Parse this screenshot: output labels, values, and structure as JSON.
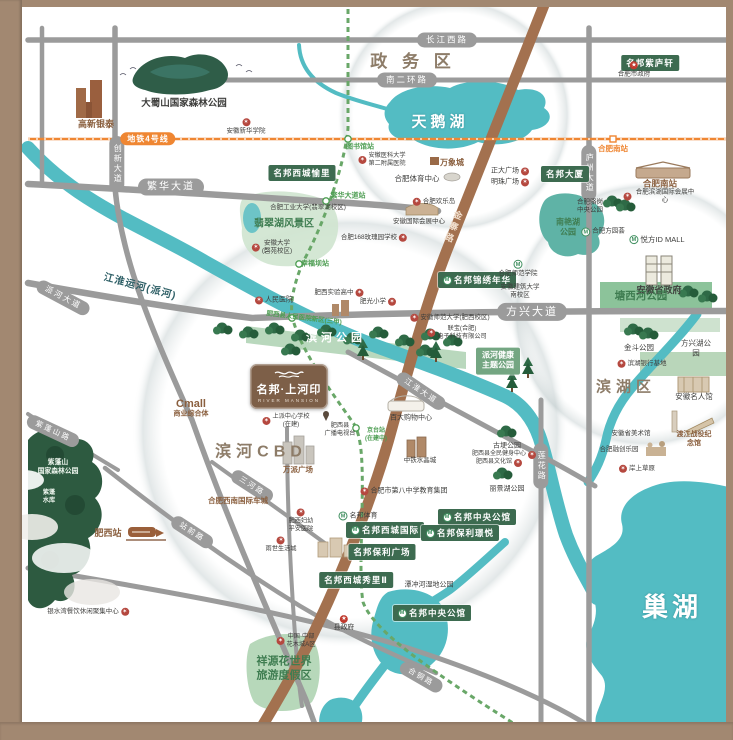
{
  "map": {
    "project_logo": {
      "name": "名邦·上河印",
      "subtitle": "RIVER MANSION"
    },
    "colors": {
      "water": "#53bcc3",
      "road": "#9b9b9b",
      "line4": "#ef8632",
      "metro": "#69a768",
      "pill": "#3d6b50",
      "brownroad": "#a3714f",
      "frame": "#a28871",
      "park": "#b9d8bd",
      "forest": "#2d5a40"
    },
    "labels": [
      {
        "n": "road-label-changjiang-west-rd",
        "t": "长江西路",
        "x": 447,
        "y": 40,
        "c": "road-pill"
      },
      {
        "n": "road-label-nanerhuan-rd",
        "t": "南二环路",
        "x": 407,
        "y": 80,
        "c": "road-pill"
      },
      {
        "n": "road-label-fanhua-ave",
        "t": "繁华大道",
        "x": 171,
        "y": 187,
        "c": "road-pill",
        "f": 10
      },
      {
        "n": "road-label-chuangxin-ave",
        "t": "创新大道",
        "x": 117,
        "y": 164,
        "c": "road-pill-v"
      },
      {
        "n": "road-label-paihe-ave",
        "t": "派河大道",
        "x": 63,
        "y": 298,
        "c": "road-pill",
        "f": 8,
        "r": 28
      },
      {
        "n": "road-label-fangxing-ave",
        "t": "方兴大道",
        "x": 532,
        "y": 312,
        "c": "road-pill",
        "f": 11
      },
      {
        "n": "road-label-luzhou-ave",
        "t": "庐州大道",
        "x": 589,
        "y": 173,
        "c": "road-pill-v"
      },
      {
        "n": "road-label-lianhua-rd",
        "t": "莲花路",
        "x": 541,
        "y": 466,
        "c": "road-pill-v"
      },
      {
        "n": "road-label-jianghuai-ave",
        "t": "江淮大道",
        "x": 421,
        "y": 391,
        "c": "road-pill",
        "f": 7.5,
        "r": 34
      },
      {
        "n": "road-label-zhanqian-rd",
        "t": "站前路",
        "x": 192,
        "y": 532,
        "c": "road-pill",
        "f": 7.5,
        "r": 33
      },
      {
        "n": "road-label-zipengshan-rd",
        "t": "紫蓬山路",
        "x": 53,
        "y": 431,
        "c": "road-pill",
        "f": 7.5,
        "r": 25
      },
      {
        "n": "road-label-sanhe-rd",
        "t": "三河路",
        "x": 252,
        "y": 486,
        "c": "road-pill",
        "f": 7.5,
        "r": 33
      },
      {
        "n": "road-label-hetong-rd",
        "t": "合铜路",
        "x": 421,
        "y": 677,
        "c": "road-pill",
        "f": 7.5,
        "r": 30
      },
      {
        "n": "road-label-jinzhai-rd",
        "t": "金寨路",
        "x": 452,
        "y": 227,
        "c": "road-brown",
        "f": 9,
        "r": 21
      },
      {
        "n": "metro-line4-badge",
        "t": "地铁4号线",
        "x": 148,
        "y": 139,
        "c": "metro-pill"
      },
      {
        "n": "station-hefeinan-metro",
        "t": "合肥南站",
        "x": 613,
        "y": 149,
        "c": "station-orange",
        "f": 7.5
      },
      {
        "n": "station-tushuguan",
        "t": "图书馆站",
        "x": 360,
        "y": 147,
        "c": "station-green",
        "f": 7
      },
      {
        "n": "station-fanhua-ave",
        "t": "繁华大道站",
        "x": 348,
        "y": 196,
        "c": "station-green",
        "f": 7
      },
      {
        "n": "station-xingfuba",
        "t": "幸福坝站",
        "x": 315,
        "y": 264,
        "c": "station-green",
        "f": 7
      },
      {
        "n": "station-jingtai",
        "t": "京台站\n(在建中)",
        "x": 376,
        "y": 436,
        "c": "station-green",
        "f": 6
      },
      {
        "n": "station-feixi-hospital",
        "t": "肥西县人民医院新区(三甲)",
        "x": 304,
        "y": 319,
        "c": "station-green",
        "f": 6.5,
        "r": 7
      },
      {
        "n": "project-mingbang-zhiluxuan",
        "t": "名邦紫庐轩",
        "x": 650,
        "y": 63,
        "c": "green-pill"
      },
      {
        "n": "project-mingbang-dasha",
        "t": "名邦大厦",
        "x": 565,
        "y": 174,
        "c": "green-pill"
      },
      {
        "n": "project-mingbang-xicheng-yuli",
        "t": "名邦西城愉里",
        "x": 302,
        "y": 173,
        "c": "green-pill"
      },
      {
        "n": "project-mingbang-jinxiu-nianhua",
        "t": "名邦锦绣年华",
        "x": 477,
        "y": 280,
        "c": "green-pill",
        "i": "m"
      },
      {
        "n": "project-mingbang-xicheng-guoji",
        "t": "名邦西城国际",
        "x": 385,
        "y": 530,
        "c": "green-pill",
        "i": "m"
      },
      {
        "n": "project-mingbang-zhongyang-gongguan-1",
        "t": "名邦中央公馆",
        "x": 477,
        "y": 517,
        "c": "green-pill",
        "i": "m"
      },
      {
        "n": "project-mingbang-baoli-jingyue",
        "t": "名邦保利璟悦",
        "x": 460,
        "y": 533,
        "c": "green-pill",
        "i": "m"
      },
      {
        "n": "project-mingbang-baoli-plaza",
        "t": "名邦保利广场",
        "x": 382,
        "y": 552,
        "c": "green-pill"
      },
      {
        "n": "project-mingbang-xicheng-xiuli",
        "t": "名邦西城秀里Ⅱ",
        "x": 356,
        "y": 580,
        "c": "green-pill"
      },
      {
        "n": "project-mingbang-zhongyang-gongguan-2",
        "t": "名邦中央公馆",
        "x": 432,
        "y": 613,
        "c": "green-pill",
        "i": "m"
      },
      {
        "n": "park-paihe-health",
        "t": "派河健康\n主题公园",
        "x": 498,
        "y": 361,
        "c": "park-pill"
      },
      {
        "n": "district-zhengwu",
        "t": "政 务 区",
        "x": 413,
        "y": 62,
        "c": "district",
        "f": 17
      },
      {
        "n": "district-binhe-cbd",
        "t": "滨河CBD",
        "x": 261,
        "y": 453,
        "c": "district",
        "f": 16
      },
      {
        "n": "district-binhu",
        "t": "滨湖区",
        "x": 626,
        "y": 387,
        "c": "district",
        "f": 15
      },
      {
        "n": "lake-tianehu-label",
        "t": "天鹅湖",
        "x": 440,
        "y": 122,
        "c": "lake-name",
        "f": 15
      },
      {
        "n": "lake-chaohu-label",
        "t": "巢湖",
        "x": 672,
        "y": 608,
        "c": "lake-name",
        "f": 26
      },
      {
        "n": "river-jianghuai-label",
        "t": "江淮运河(派河)",
        "x": 140,
        "y": 287,
        "c": "river-name",
        "f": 10,
        "r": 15
      },
      {
        "n": "park-binhe-label",
        "t": "滨河公园",
        "x": 336,
        "y": 338,
        "c": "park-white",
        "f": 11
      },
      {
        "n": "poi-gaoxin-yintai",
        "t": "高新银泰",
        "x": 96,
        "y": 125,
        "c": "poi-brown",
        "f": 9
      },
      {
        "n": "poi-dashushan",
        "t": "大蜀山国家森林公园",
        "x": 184,
        "y": 104,
        "c": "poi",
        "f": 9.5,
        "b": 1
      },
      {
        "n": "poi-anhui-xinhua",
        "t": "安徽新华学院",
        "x": 246,
        "y": 127,
        "c": "poi col",
        "f": 6.5,
        "i": "s"
      },
      {
        "n": "poi-hefei-gov",
        "t": "合肥市政府",
        "x": 634,
        "y": 70,
        "c": "poi col",
        "f": 6.5,
        "i": "g"
      },
      {
        "n": "poi-zhengda-plaza",
        "t": "正大广场",
        "x": 510,
        "y": 171,
        "c": "poi",
        "f": 7,
        "i": "s",
        "p": "r"
      },
      {
        "n": "poi-mingzhu-plaza",
        "t": "明珠广场",
        "x": 510,
        "y": 182,
        "c": "poi",
        "f": 7,
        "i": "s",
        "p": "r"
      },
      {
        "n": "poi-hefeinan-railway",
        "t": "合肥南站",
        "x": 660,
        "y": 184,
        "c": "poi-brown",
        "f": 8.5
      },
      {
        "n": "poi-binhu-expo",
        "t": "合肥滨湖国际会展中心",
        "x": 660,
        "y": 197,
        "c": "poi",
        "f": 6.5,
        "i": "s"
      },
      {
        "n": "poi-luogang-park",
        "t": "合肥骆岗\n中央公园",
        "x": 590,
        "y": 207,
        "c": "poi",
        "f": 6.5
      },
      {
        "n": "park-nanyanhu",
        "t": "南艳湖\n公园",
        "x": 568,
        "y": 228,
        "c": "park-name",
        "f": 8
      },
      {
        "n": "poi-fangyuanhui",
        "t": "合肥方园荟",
        "x": 603,
        "y": 232,
        "c": "poi",
        "f": 6.5,
        "i": "m"
      },
      {
        "n": "poi-yuefang-id-mall",
        "t": "悦方ID MALL",
        "x": 657,
        "y": 240,
        "c": "poi",
        "f": 7.5,
        "i": "m"
      },
      {
        "n": "poi-anhui-gov",
        "t": "安徽省政府",
        "x": 659,
        "y": 291,
        "c": "poi",
        "f": 9,
        "b": 1
      },
      {
        "n": "park-tangxihe",
        "t": "塘西河公园",
        "x": 641,
        "y": 297,
        "c": "park-name",
        "f": 10.5
      },
      {
        "n": "poi-hefei-normal",
        "t": "合肥师范学院",
        "x": 518,
        "y": 269,
        "c": "poi col",
        "f": 6.5,
        "i": "m"
      },
      {
        "n": "poi-anhui-jianzhu",
        "t": "安徽建筑大学\n南校区",
        "x": 520,
        "y": 292,
        "c": "poi",
        "f": 6.5
      },
      {
        "n": "park-jindou",
        "t": "金斗公园",
        "x": 639,
        "y": 348,
        "c": "poi",
        "f": 7.5
      },
      {
        "n": "park-fangxinghu",
        "t": "方兴湖公园",
        "x": 696,
        "y": 348,
        "c": "poi",
        "f": 7.5
      },
      {
        "n": "poi-binhu-bank-base",
        "t": "滨湖银行基地",
        "x": 642,
        "y": 364,
        "c": "poi",
        "f": 6.5,
        "i": "s"
      },
      {
        "n": "poi-anhui-mingren-hall",
        "t": "安徽名人馆",
        "x": 694,
        "y": 397,
        "c": "poi",
        "f": 7.5
      },
      {
        "n": "poi-anhui-art-museum",
        "t": "安徽省美术馆",
        "x": 631,
        "y": 434,
        "c": "poi",
        "f": 6.5
      },
      {
        "n": "poi-dujiang-memorial",
        "t": "渡江战役纪念馆",
        "x": 694,
        "y": 439,
        "c": "poi-brown",
        "f": 7
      },
      {
        "n": "poi-rongchuang-park",
        "t": "合肥融创乐园",
        "x": 619,
        "y": 450,
        "c": "poi",
        "f": 6.5
      },
      {
        "n": "poi-anshang-grassland",
        "t": "岸上草原",
        "x": 637,
        "y": 469,
        "c": "poi",
        "f": 6.5,
        "i": "s"
      },
      {
        "n": "poi-anhui-normal-univ",
        "t": "安徽师范大学(肥西校区)",
        "x": 450,
        "y": 318,
        "c": "poi",
        "f": 6.5,
        "i": "s"
      },
      {
        "n": "poi-lianbao",
        "t": "联宝(合肥)\n电子科技有限公司",
        "x": 457,
        "y": 333,
        "c": "poi",
        "f": 6.2,
        "i": "s"
      },
      {
        "n": "poi-hfut",
        "t": "合肥工业大学(翡翠湖校区)",
        "x": 308,
        "y": 208,
        "c": "poi",
        "f": 6.5
      },
      {
        "n": "park-feicuihu",
        "t": "翡翠湖风景区",
        "x": 284,
        "y": 224,
        "c": "park-name",
        "f": 10
      },
      {
        "n": "poi-anhui-univ",
        "t": "安徽大学\n(磬苑校区)",
        "x": 272,
        "y": 248,
        "c": "poi",
        "f": 6.5,
        "i": "s"
      },
      {
        "n": "poi-renmin-hospital",
        "t": "人民医院",
        "x": 274,
        "y": 300,
        "c": "poi",
        "f": 7,
        "i": "s"
      },
      {
        "n": "poi-feixi-shiyan-school",
        "t": "肥西实验高中",
        "x": 339,
        "y": 293,
        "c": "poi",
        "f": 6.5,
        "i": "s",
        "p": "r"
      },
      {
        "n": "poi-feiguang-primary",
        "t": "肥光小学",
        "x": 378,
        "y": 302,
        "c": "poi",
        "f": 6.5,
        "i": "s",
        "p": "r"
      },
      {
        "n": "poi-huanledao",
        "t": "合肥欢乐岛",
        "x": 434,
        "y": 202,
        "c": "poi",
        "f": 6.5,
        "i": "s"
      },
      {
        "n": "poi-intl-expo-center",
        "t": "安徽国际会展中心",
        "x": 419,
        "y": 222,
        "c": "poi",
        "f": 6.5
      },
      {
        "n": "poi-168-school",
        "t": "合肥168玫瑰园学校",
        "x": 374,
        "y": 238,
        "c": "poi",
        "f": 6.5,
        "i": "s",
        "p": "r"
      },
      {
        "n": "poi-anyida-2nd-hospital",
        "t": "安徽医科大学\n第二附属医院",
        "x": 382,
        "y": 160,
        "c": "poi",
        "f": 6.2,
        "i": "s"
      },
      {
        "n": "poi-wanxiangcheng",
        "t": "万象城",
        "x": 452,
        "y": 163,
        "c": "poi-brown",
        "f": 8
      },
      {
        "n": "poi-hefei-sports-center",
        "t": "合肥体育中心",
        "x": 417,
        "y": 179,
        "c": "poi",
        "f": 7.5
      },
      {
        "n": "poi-shangpai-school",
        "t": "上派中心学校\n(在建)",
        "x": 286,
        "y": 421,
        "c": "poi",
        "f": 6.2,
        "i": "s"
      },
      {
        "n": "poi-feixi-tv-station",
        "t": "肥西县\n广播电视台",
        "x": 340,
        "y": 430,
        "c": "poi",
        "f": 6.2
      },
      {
        "n": "poi-baida-shopping",
        "t": "百大购物中心",
        "x": 411,
        "y": 418,
        "c": "poi",
        "f": 7
      },
      {
        "n": "poi-zhongtie-crystal-city",
        "t": "中铁水晶城",
        "x": 420,
        "y": 461,
        "c": "poi",
        "f": 6.5
      },
      {
        "n": "poi-wanpai-plaza",
        "t": "万派广场",
        "x": 298,
        "y": 470,
        "c": "poi-brown",
        "f": 7.5
      },
      {
        "n": "park-gugeng",
        "t": "古埂公园",
        "x": 507,
        "y": 446,
        "c": "poi",
        "f": 7
      },
      {
        "n": "poi-quanmin-fitness-center",
        "t": "肥西县全民健身中心",
        "x": 504,
        "y": 455,
        "c": "poi",
        "f": 6,
        "i": "s",
        "p": "r"
      },
      {
        "n": "poi-feixi-culture-hall",
        "t": "肥西县文化馆",
        "x": 499,
        "y": 463,
        "c": "poi",
        "f": 6,
        "i": "s",
        "p": "r"
      },
      {
        "n": "park-lijinghu",
        "t": "丽景湖公园",
        "x": 507,
        "y": 489,
        "c": "poi",
        "f": 7
      },
      {
        "n": "poi-no8-middle-school",
        "t": "合肥市第八中学教育集团",
        "x": 404,
        "y": 491,
        "c": "poi",
        "f": 7,
        "i": "s"
      },
      {
        "n": "poi-mingbang-sports",
        "t": "名邦体育",
        "x": 358,
        "y": 516,
        "c": "poi",
        "f": 7,
        "i": "m"
      },
      {
        "n": "park-tanchonghe-wetland",
        "t": "潭冲河湿地公园",
        "x": 429,
        "y": 585,
        "c": "poi",
        "f": 7
      },
      {
        "n": "poi-feixi-fuyou-hospital",
        "t": "肥西妇幼\n平安医院",
        "x": 301,
        "y": 521,
        "c": "poi col",
        "f": 6.2,
        "i": "s"
      },
      {
        "n": "poi-yushi-life-city",
        "t": "雨世生活城",
        "x": 281,
        "y": 545,
        "c": "poi col",
        "f": 6.2,
        "i": "s"
      },
      {
        "n": "poi-southwest-auto-city",
        "t": "合肥西南国际车城",
        "x": 238,
        "y": 501,
        "c": "poi-brown",
        "f": 7.5
      },
      {
        "n": "poi-cmall",
        "t": "Cmall",
        "x": 191,
        "y": 404,
        "c": "poi-brown",
        "f": 11
      },
      {
        "n": "poi-cmall-sub",
        "t": "商业综合体",
        "x": 191,
        "y": 414,
        "c": "poi-brown",
        "f": 7
      },
      {
        "n": "poi-feixi-railway-station",
        "t": "肥西站",
        "x": 108,
        "y": 534,
        "c": "poi-brown",
        "f": 9
      },
      {
        "n": "park-zipengshan",
        "t": "紫蓬山\n国家森林公园",
        "x": 58,
        "y": 468,
        "c": "white-name",
        "f": 6.8
      },
      {
        "n": "water-zipeng-reservoir",
        "t": "紫蓬\n水库",
        "x": 49,
        "y": 497,
        "c": "white-name",
        "f": 6.2
      },
      {
        "n": "poi-yinshuiwan",
        "t": "银水湾餐饮休闲聚集中心",
        "x": 88,
        "y": 612,
        "c": "poi",
        "f": 6.5,
        "i": "s",
        "p": "r"
      },
      {
        "n": "poi-county-gov",
        "t": "县政府",
        "x": 344,
        "y": 624,
        "c": "poi col",
        "f": 6.8,
        "i": "g"
      },
      {
        "n": "poi-huamucheng",
        "t": "中国·中部\n花木城A区",
        "x": 296,
        "y": 641,
        "c": "poi",
        "f": 6.2,
        "i": "s"
      },
      {
        "n": "park-xiangyuan-flower-world",
        "t": "祥源花世界\n旅游度假区",
        "x": 284,
        "y": 669,
        "c": "park-name",
        "f": 11
      }
    ]
  }
}
